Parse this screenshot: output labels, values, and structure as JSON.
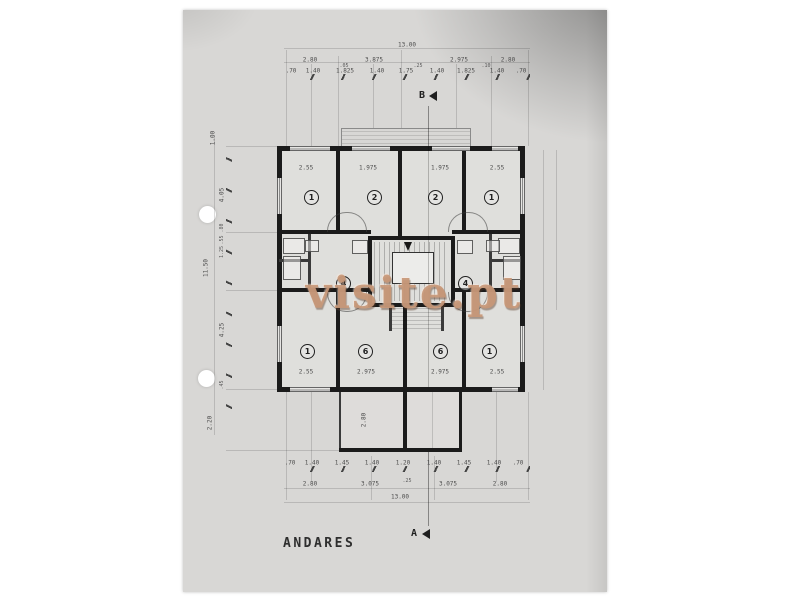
{
  "document": {
    "type_label": "architectural floor plan (scanned blueprint)",
    "title_label": "ANDARES",
    "watermark": "visite.pt",
    "watermark_color": "#c79777",
    "paper_color": "#d8d7d5",
    "wall_color": "#1b1b1b"
  },
  "section_markers": {
    "top": "B",
    "bottom": "A"
  },
  "rooms": {
    "top": [
      "1",
      "2",
      "2",
      "1"
    ],
    "middle": [
      "4",
      "4"
    ],
    "bottom": [
      "1",
      "6",
      "6",
      "1"
    ]
  },
  "dimensions": {
    "top": {
      "overall": "13.00",
      "segments": [
        "2.80",
        "3.875",
        "2.975",
        "2.80"
      ],
      "inter": [
        ".05",
        ".25",
        ".10"
      ],
      "detail": [
        ".70",
        "1.40",
        "1.825",
        "1.40",
        "1.75",
        "1.40",
        "1.825",
        "1.40",
        ".70"
      ]
    },
    "bottom": {
      "detail": [
        ".70",
        "1.40",
        "1.45",
        "1.40",
        "1.20",
        "1.40",
        "1.45",
        "1.40",
        ".70"
      ],
      "segments": [
        "2.80",
        "3.075",
        "3.075",
        "2.80"
      ],
      "inter": ".25",
      "overall": "13.00"
    },
    "left": [
      "1.00",
      "4.05",
      ".80",
      ".55",
      "1.25",
      "11.50",
      "4.25",
      ".45",
      "2.20"
    ],
    "rooms_top": [
      "2.55",
      "1.975",
      "1.975",
      "2.55"
    ],
    "rooms_bottom": [
      "2.55",
      "2.975",
      "2.975",
      "2.55"
    ],
    "garage": "2.80"
  }
}
